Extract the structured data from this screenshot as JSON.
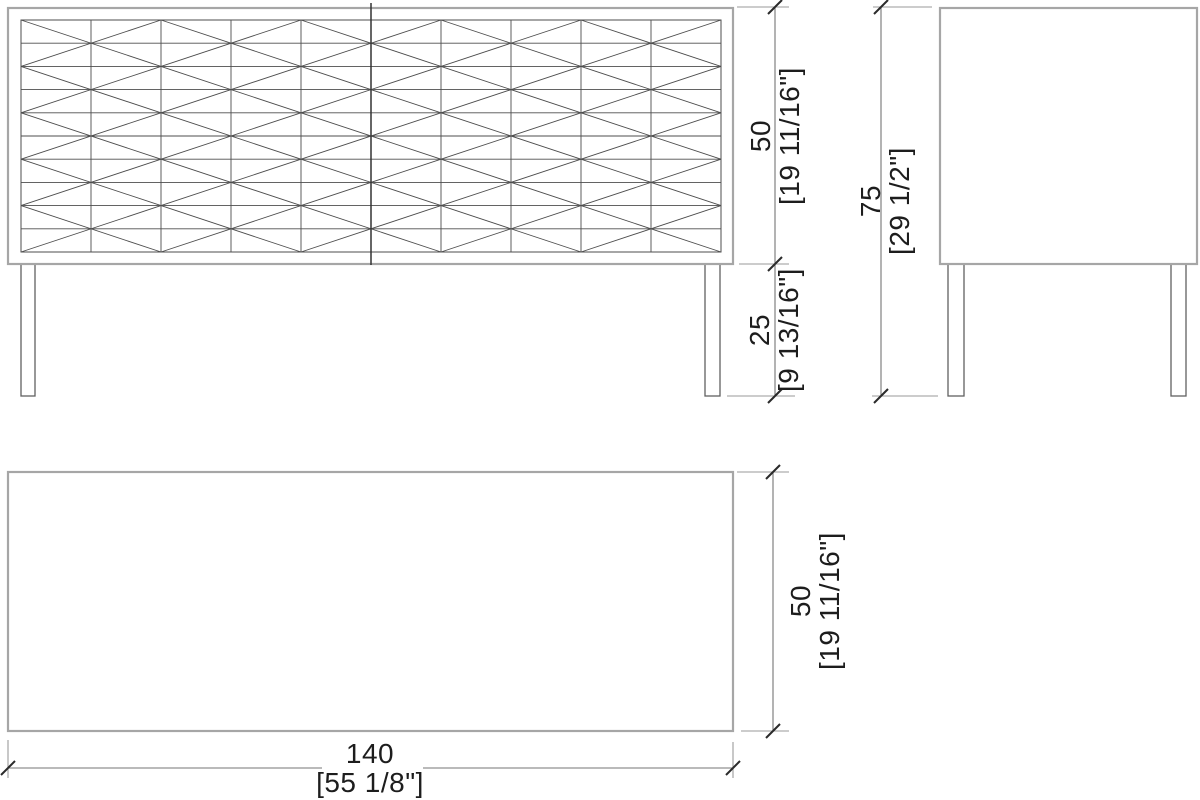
{
  "drawing": {
    "type": "furniture-orthographic-dimension-drawing",
    "views": {
      "front": "front-elevation-with-diamond-lattice",
      "side": "side-elevation",
      "plan": "top-plan"
    },
    "front_pattern": {
      "columns": 10,
      "rows": 10,
      "diamond_columns": 5,
      "diamond_rows": 5
    },
    "dimensions": [
      {
        "id": "body_height",
        "value": "50",
        "imperial": "[19 11/16\"]"
      },
      {
        "id": "leg_height",
        "value": "25",
        "imperial": "[9 13/16\"]"
      },
      {
        "id": "total_height",
        "value": "75",
        "imperial": "[29 1/2\"]"
      },
      {
        "id": "plan_depth",
        "value": "50",
        "imperial": "[19 11/16\"]"
      },
      {
        "id": "overall_width",
        "value": "140",
        "imperial": "[55 1/8\"]"
      }
    ],
    "colors": {
      "background": "#ffffff",
      "object_outline": "#a6a6a6",
      "pattern_line": "#4d4d4d",
      "leg_line": "#606060",
      "dimension_line": "#757575",
      "extension_line": "#9a9a9a",
      "tick_mark": "#2b2b2b",
      "text": "#1d1d1d"
    }
  }
}
